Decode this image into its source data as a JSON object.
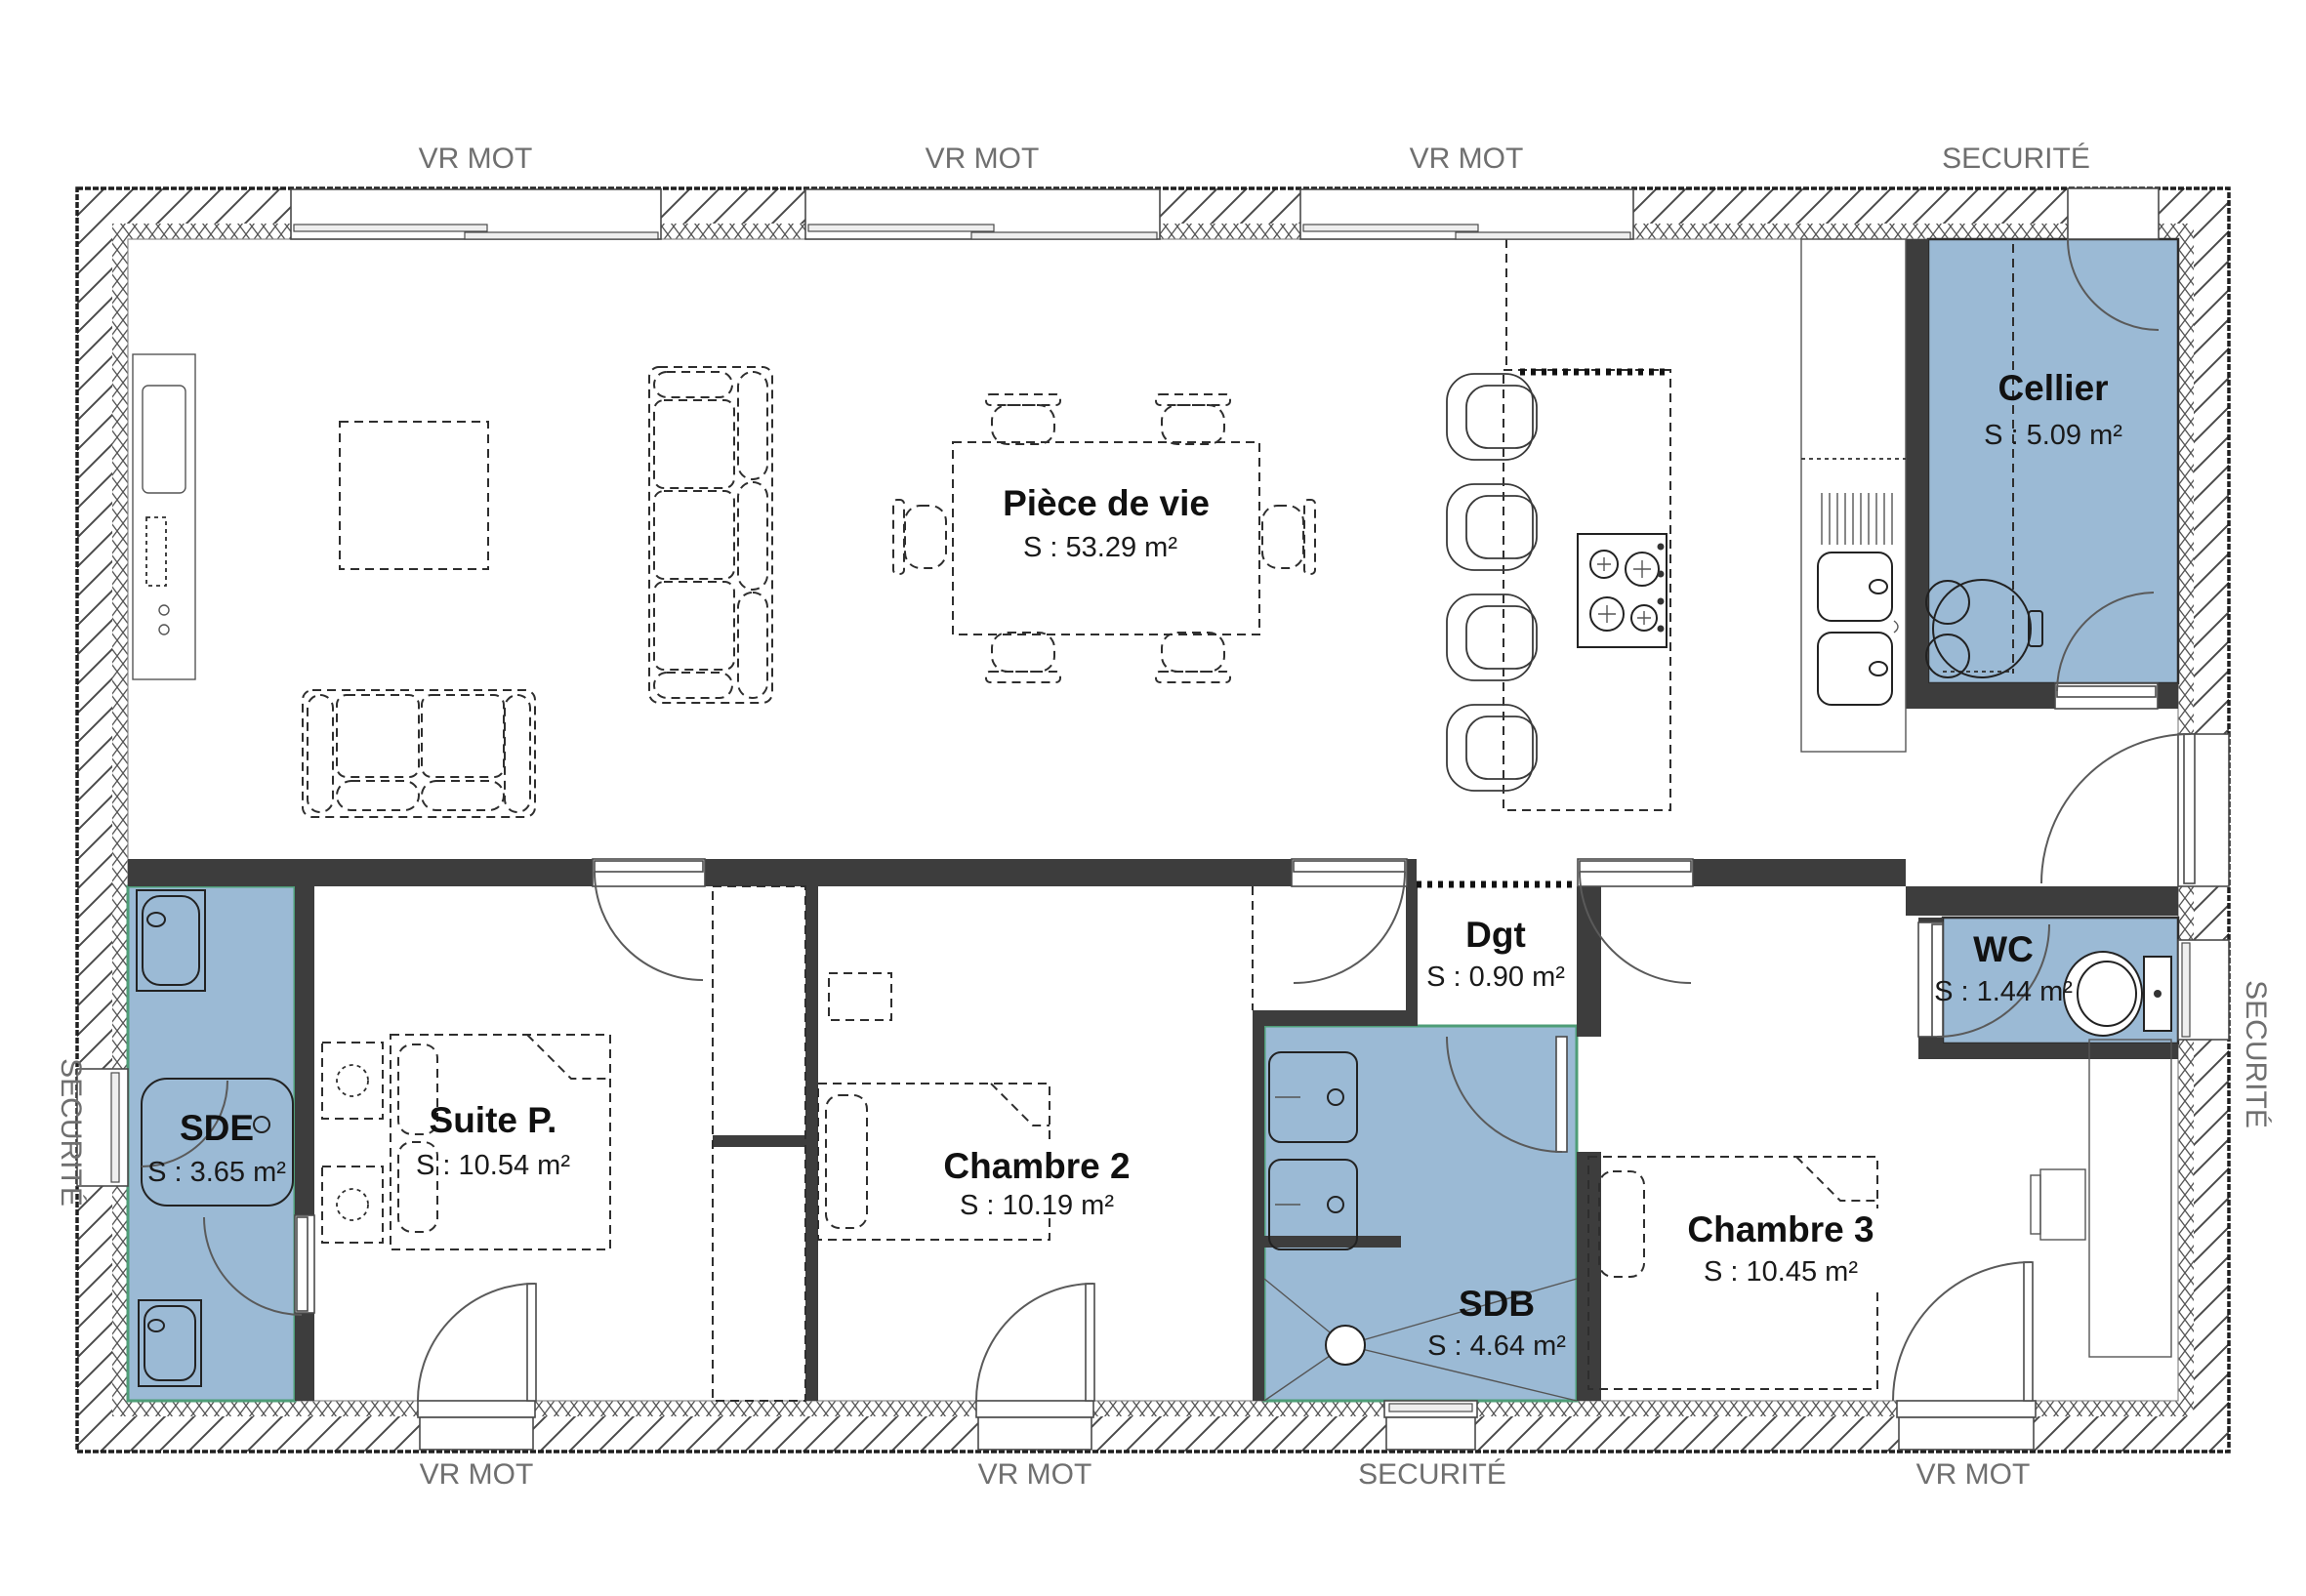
{
  "plan": {
    "rooms": [
      {
        "id": "piece-de-vie",
        "name": "Pièce de vie",
        "area": "S : 53.29 m²"
      },
      {
        "id": "cellier",
        "name": "Cellier",
        "area": "S : 5.09 m²"
      },
      {
        "id": "sde",
        "name": "SDE",
        "area": "S : 3.65 m²"
      },
      {
        "id": "suite-parentale",
        "name": "Suite P.",
        "area": "S : 10.54 m²"
      },
      {
        "id": "chambre-2",
        "name": "Chambre 2",
        "area": "S : 10.19 m²"
      },
      {
        "id": "degagement",
        "name": "Dgt",
        "area": "S : 0.90 m²"
      },
      {
        "id": "sdb",
        "name": "SDB",
        "area": "S : 4.64 m²"
      },
      {
        "id": "chambre-3",
        "name": "Chambre 3",
        "area": "S : 10.45 m²"
      },
      {
        "id": "wc",
        "name": "WC",
        "area": "S : 1.44 m²"
      }
    ],
    "exterior_labels": {
      "top": [
        "VR MOT",
        "VR MOT",
        "VR MOT",
        "SECURITÉ"
      ],
      "bottom": [
        "VR MOT",
        "VR MOT",
        "SECURITÉ",
        "VR MOT"
      ],
      "left": "SECURITÉ",
      "right": "SECURITÉ"
    },
    "colors": {
      "wet_room_fill": "#9bbad5",
      "wall_fill": "#3d3d3d",
      "label_gray": "#6f6f6f",
      "accent_green": "#4e9d77"
    }
  }
}
